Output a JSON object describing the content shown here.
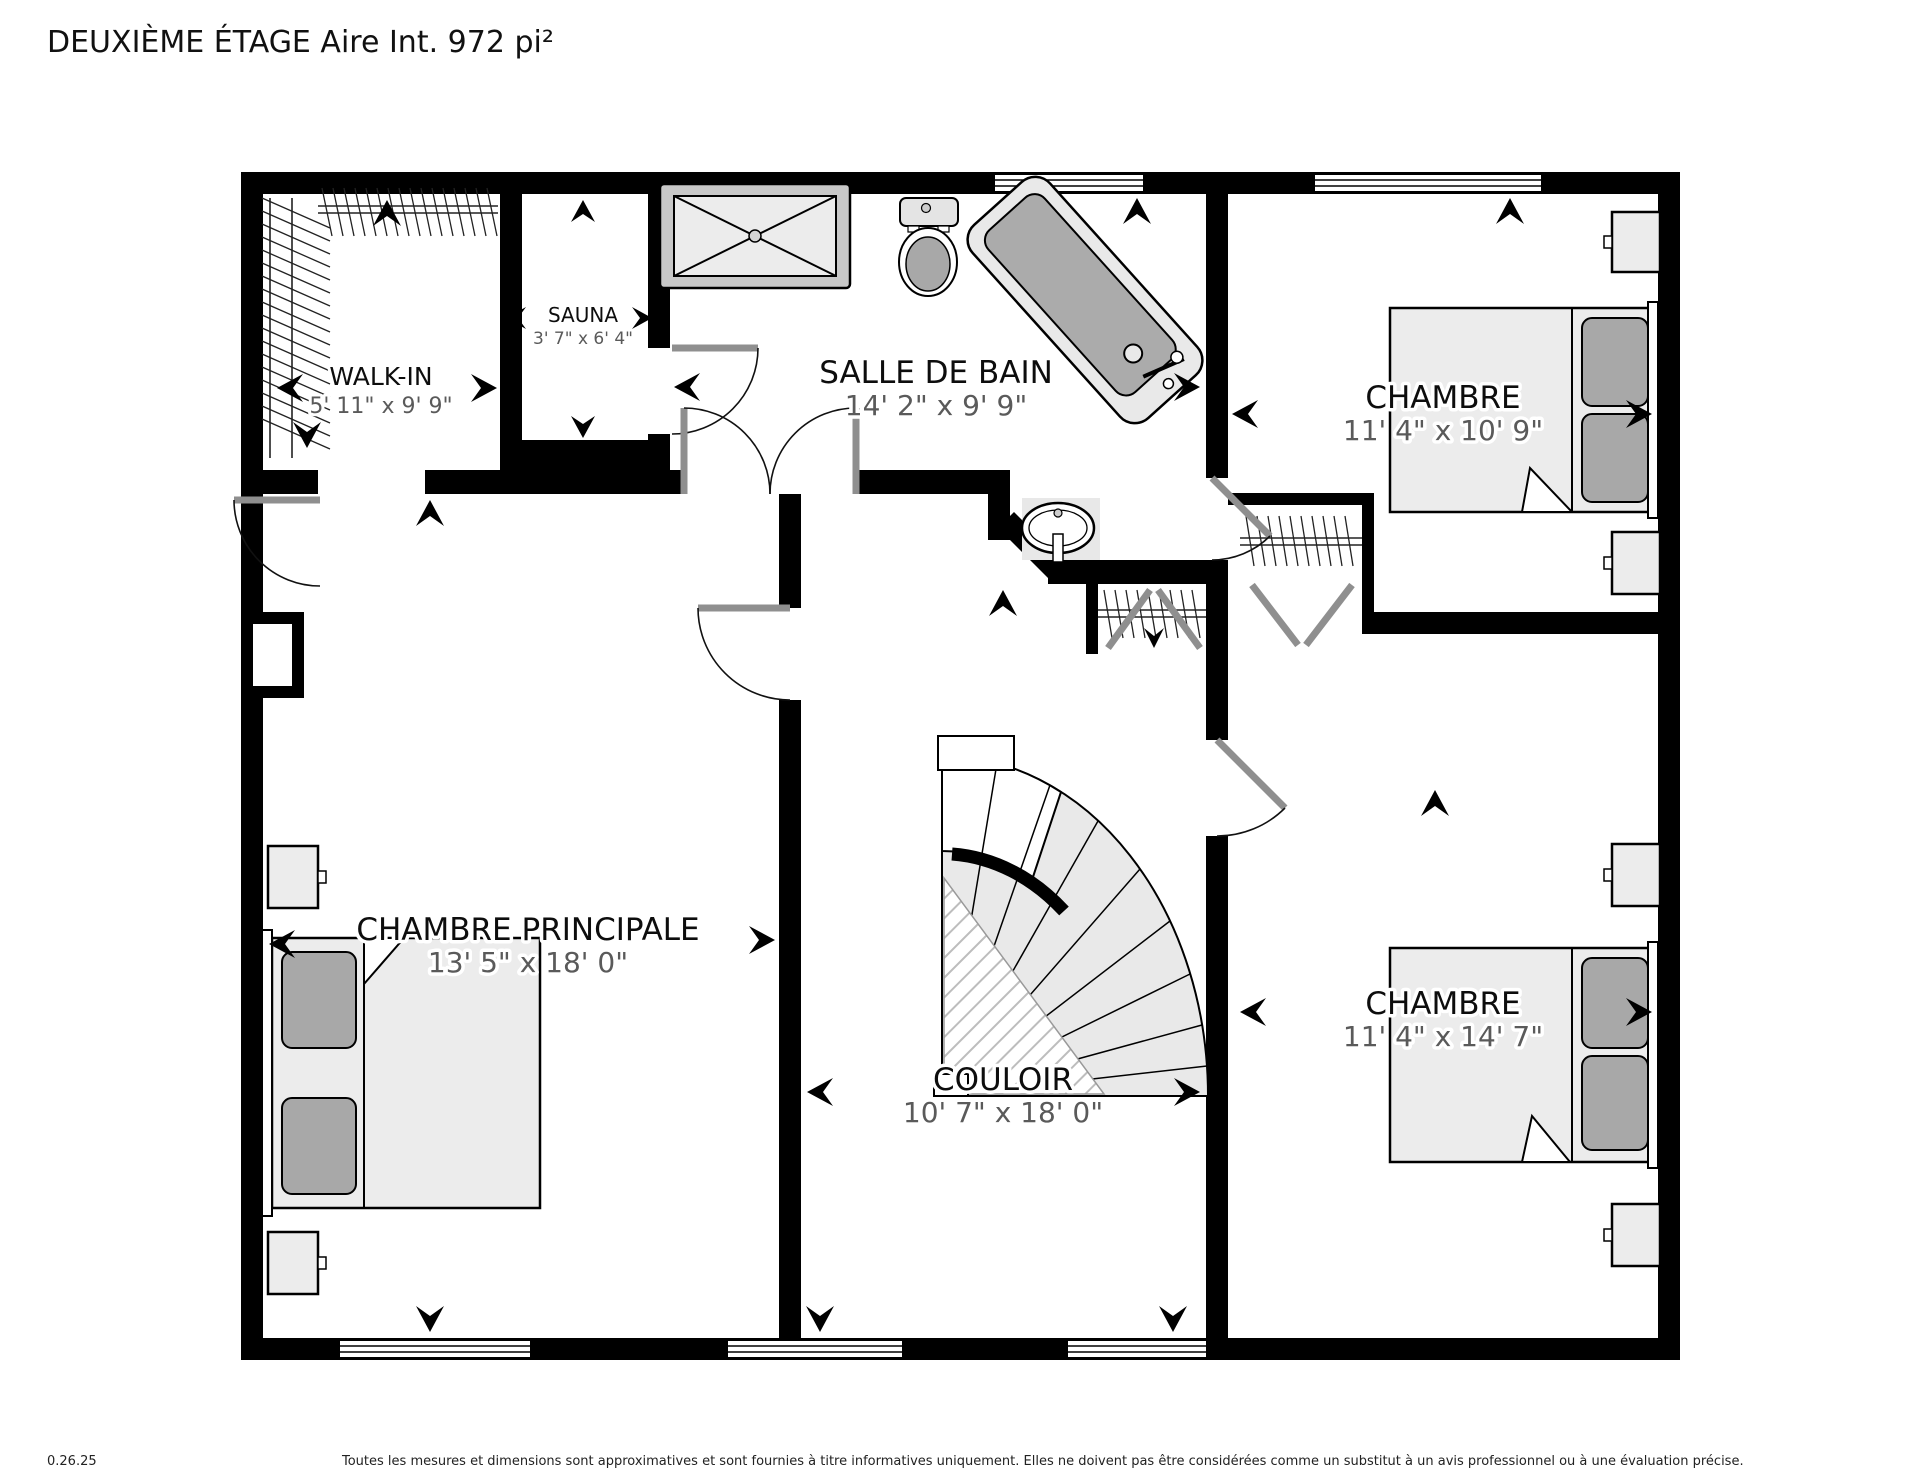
{
  "title": "DEUXIÈME ÉTAGE Aire Int. 972 pi²",
  "rooms": [
    {
      "id": "walk-in",
      "name": "WALK-IN",
      "dimensions": "5' 11\" x 9' 9\""
    },
    {
      "id": "sauna",
      "name": "SAUNA",
      "dimensions": "3' 7\" x 6' 4\""
    },
    {
      "id": "salle-de-bain",
      "name": "SALLE DE BAIN",
      "dimensions": "14' 2\" x 9' 9\""
    },
    {
      "id": "chambre-1",
      "name": "CHAMBRE",
      "dimensions": "11' 4\" x 10' 9\""
    },
    {
      "id": "chambre-principale",
      "name": "CHAMBRE PRINCIPALE",
      "dimensions": "13' 5\" x 18' 0\""
    },
    {
      "id": "couloir",
      "name": "COULOIR",
      "dimensions": "10' 7\" x 18' 0\""
    },
    {
      "id": "chambre-2",
      "name": "CHAMBRE",
      "dimensions": "11' 4\" x 14' 7\""
    }
  ],
  "fixtures": [
    "shower",
    "toilet",
    "bathtub",
    "sink",
    "double-bed",
    "nightstand",
    "fan-staircase",
    "closet-rod",
    "bifold-door"
  ],
  "footer": {
    "version": "0.26.25",
    "disclaimer": "Toutes les mesures et dimensions sont approximatives et sont fournies à titre informatives uniquement. Elles ne doivent pas être considérées comme un substitut à un avis professionnel ou à une évaluation précise."
  },
  "colors": {
    "wall": "#000000",
    "floor": "#ffffff",
    "furniture": "#ececec",
    "furniture_dark": "#a8a8a8",
    "dimension_text": "#5a5a5a",
    "door_leaf": "#8f8f8f"
  }
}
